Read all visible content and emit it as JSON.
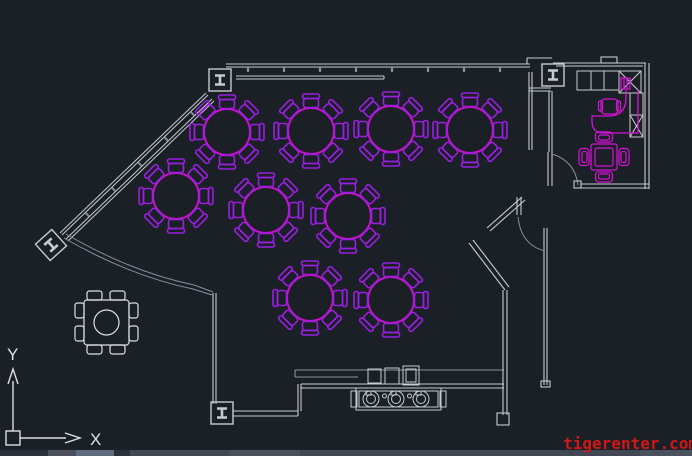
{
  "app": {
    "background": "#1b1f26"
  },
  "watermark": {
    "text": "tigerenter.com",
    "color": "#d01818"
  },
  "ucs_icon": {
    "x_label": "X",
    "y_label": "Y"
  },
  "colors": {
    "bg": "#1b1f26",
    "wall": "#c7ccd2",
    "wall_dim": "#8a9099",
    "ucs": "#dde1e6",
    "table": "#c414c8",
    "chair": "#9a1fe0",
    "furniture": "#d713d7",
    "statusbar_base": "#414853",
    "statusbar_dark": "#2b313b",
    "statusbar_light": "#5d6b7c",
    "statusbar_mid": "#4a515c"
  },
  "floor_plan": {
    "round_table_radius": 23,
    "round_table_chairs": 8,
    "round_tables": [
      {
        "cx": 227,
        "cy": 132
      },
      {
        "cx": 311,
        "cy": 131
      },
      {
        "cx": 391,
        "cy": 129
      },
      {
        "cx": 470,
        "cy": 130
      },
      {
        "cx": 176,
        "cy": 196
      },
      {
        "cx": 266,
        "cy": 210
      },
      {
        "cx": 348,
        "cy": 216
      },
      {
        "cx": 310,
        "cy": 298
      },
      {
        "cx": 391,
        "cy": 300
      }
    ],
    "terrace_table": {
      "cx": 106,
      "cy": 322,
      "chairs": 8
    },
    "office": {
      "square_table": {
        "cx": 604,
        "cy": 157,
        "chairs": 4
      },
      "desk_chair": {
        "cx": 609,
        "cy": 107
      },
      "cabinet_cells": 3
    },
    "counter": {
      "burner_cy": 399,
      "burners": [
        {
          "cx": 371
        },
        {
          "cx": 396
        },
        {
          "cx": 421
        }
      ]
    }
  }
}
